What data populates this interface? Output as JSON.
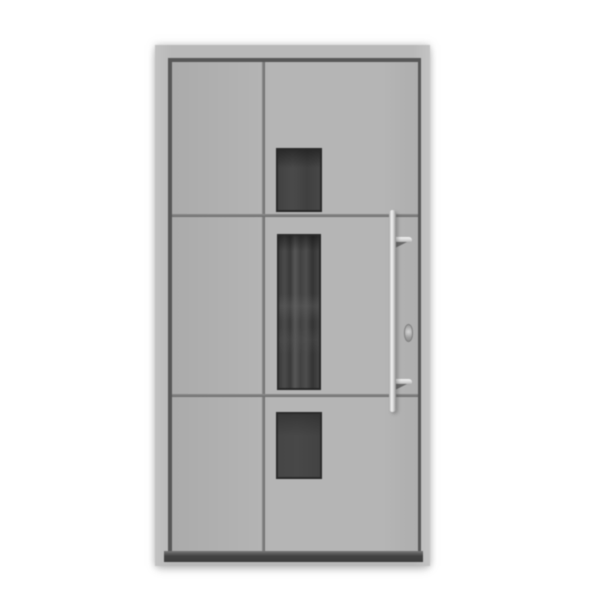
{
  "scene": {
    "description": "Product photo of a modern light-gray aluminium front entry door: outer frame with dark rebate joint, door leaf with one vertical and two horizontal grooves dividing it into three sections, three dark rectangular glass panels stacked vertically (small top pane, tall middle pane, small bottom pane), a long vertical stainless-steel pull handle with two mounting brackets on the right side, a small lock cylinder, and a dark threshold bar at the bottom, on a white background.",
    "colors": {
      "background": "#ffffff",
      "frame": "#b9b9b9",
      "frame_gap": "#575757",
      "leaf": "#b5b5b5",
      "leaf_shade": "#ababab",
      "groove": "#7a7a7a",
      "glass_dark": "#343434",
      "glass_mid": "#484848",
      "glass_light": "#575757",
      "threshold": "#434343",
      "handle_light": "#f4f4f4",
      "handle_mid": "#cccccc",
      "handle_dark": "#8c8c8c",
      "cylinder": "#9e9e9e"
    }
  }
}
